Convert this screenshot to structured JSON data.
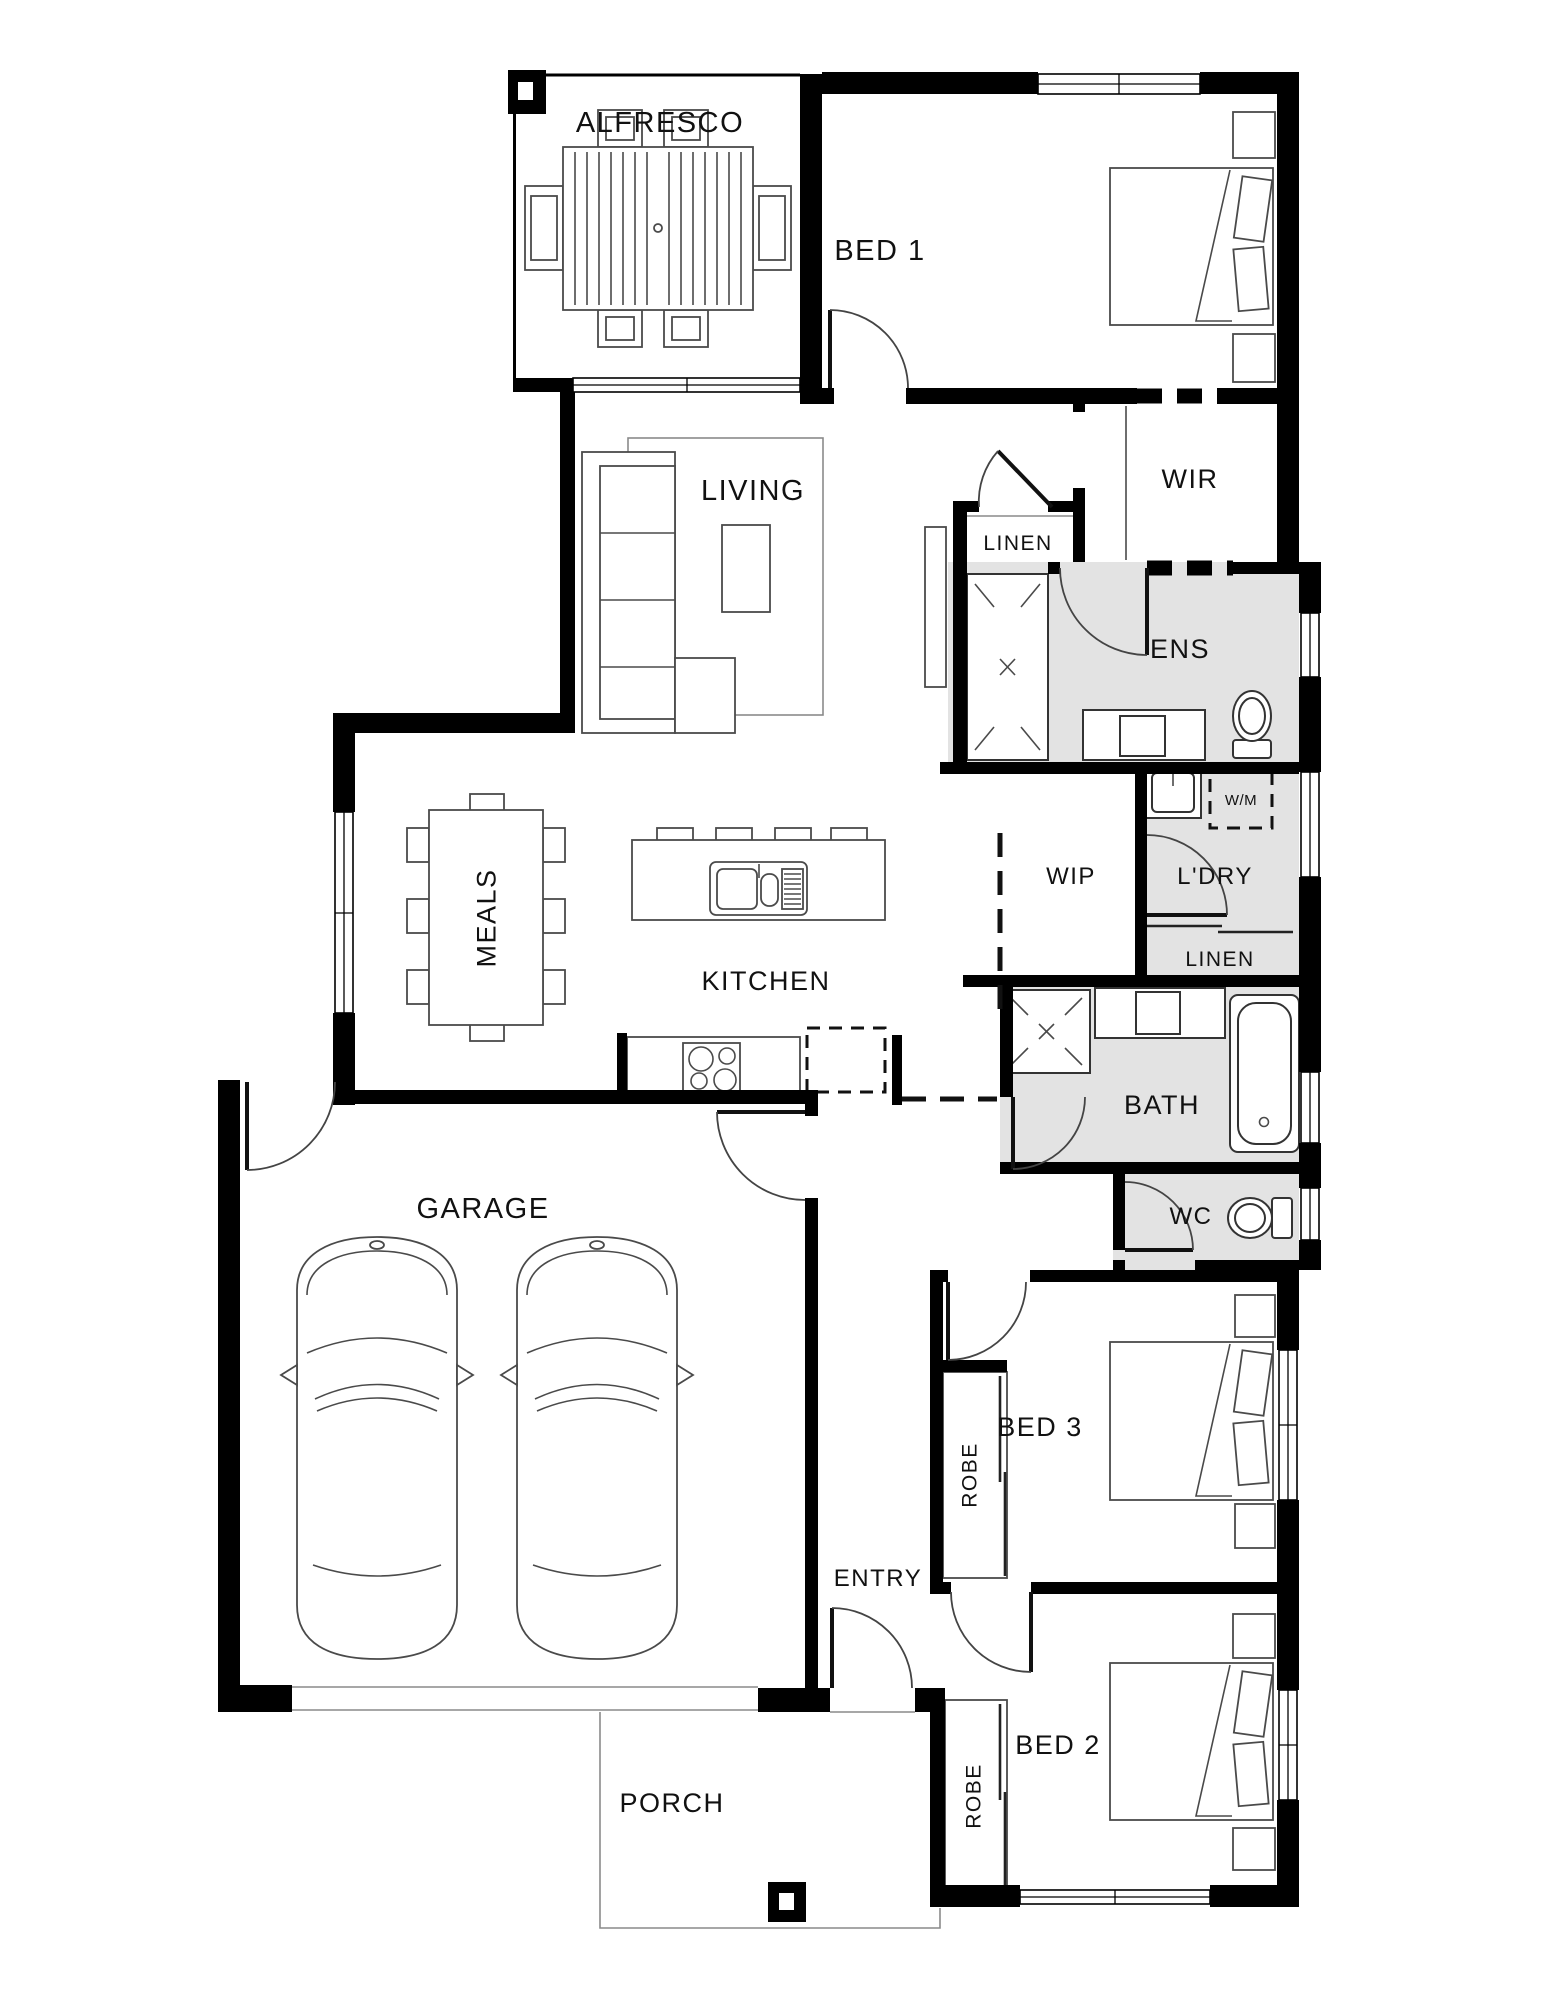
{
  "plan": {
    "type": "floor-plan",
    "rooms": {
      "alfresco": "ALFRESCO",
      "bed1": "BED 1",
      "living": "LIVING",
      "wir": "WIR",
      "linen_hall": "LINEN",
      "ens": "ENS",
      "meals": "MEALS",
      "kitchen": "KITCHEN",
      "wip": "WIP",
      "laundry": "L'DRY",
      "washing_machine": "W/M",
      "linen_laundry": "LINEN",
      "bath": "BATH",
      "wc": "WC",
      "garage": "GARAGE",
      "bed3": "BED 3",
      "robe_bed3": "ROBE",
      "entry": "ENTRY",
      "bed2": "BED 2",
      "robe_bed2": "ROBE",
      "porch": "PORCH"
    },
    "colors": {
      "wall": "#000000",
      "wet_area": "#e3e3e3",
      "furniture_line": "#4a4a4a",
      "text": "#111111",
      "background": "#ffffff"
    }
  }
}
